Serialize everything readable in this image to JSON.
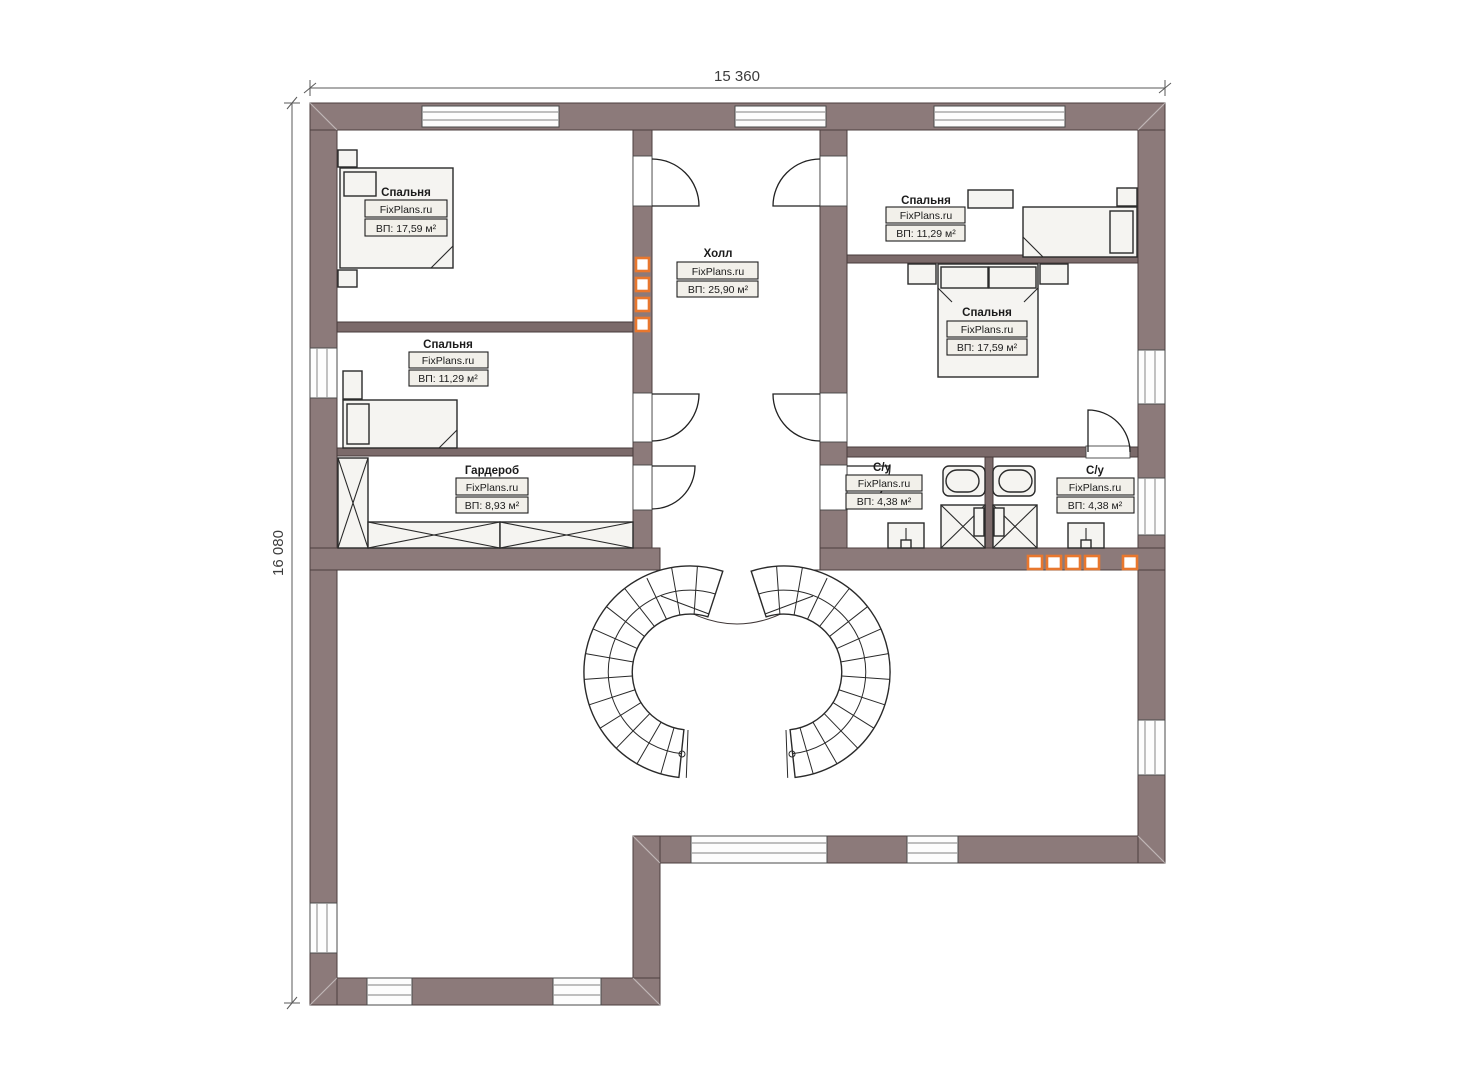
{
  "plan": {
    "title": "floor-plan-second-level",
    "dimensions": {
      "top": "15 360",
      "left": "16 080"
    },
    "brand": "FixPlans.ru",
    "rooms": [
      {
        "id": "bedroom-top-left",
        "name": "Спальня",
        "brand": "FixPlans.ru",
        "area": "ВП: 17,59 м²"
      },
      {
        "id": "bedroom-mid-left",
        "name": "Спальня",
        "brand": "FixPlans.ru",
        "area": "ВП: 11,29 м²"
      },
      {
        "id": "wardrobe",
        "name": "Гардероб",
        "brand": "FixPlans.ru",
        "area": "ВП: 8,93 м²"
      },
      {
        "id": "hall",
        "name": "Холл",
        "brand": "FixPlans.ru",
        "area": "ВП: 25,90 м²"
      },
      {
        "id": "bedroom-top-right",
        "name": "Спальня",
        "brand": "FixPlans.ru",
        "area": "ВП: 11,29 м²"
      },
      {
        "id": "bedroom-mid-right",
        "name": "Спальня",
        "brand": "FixPlans.ru",
        "area": "ВП: 17,59 м²"
      },
      {
        "id": "bathroom-left",
        "name": "С/у",
        "brand": "FixPlans.ru",
        "area": "ВП: 4,38 м²"
      },
      {
        "id": "bathroom-right",
        "name": "С/у",
        "brand": "FixPlans.ru",
        "area": "ВП: 4,38 м²"
      }
    ],
    "colors": {
      "wall": "#8c7a7a",
      "bedroom_floor": "#8a7355",
      "hall_tile": "#cfbd92",
      "bathroom_tile": "#c9e0f4",
      "vent_accent": "#e8772e"
    }
  }
}
